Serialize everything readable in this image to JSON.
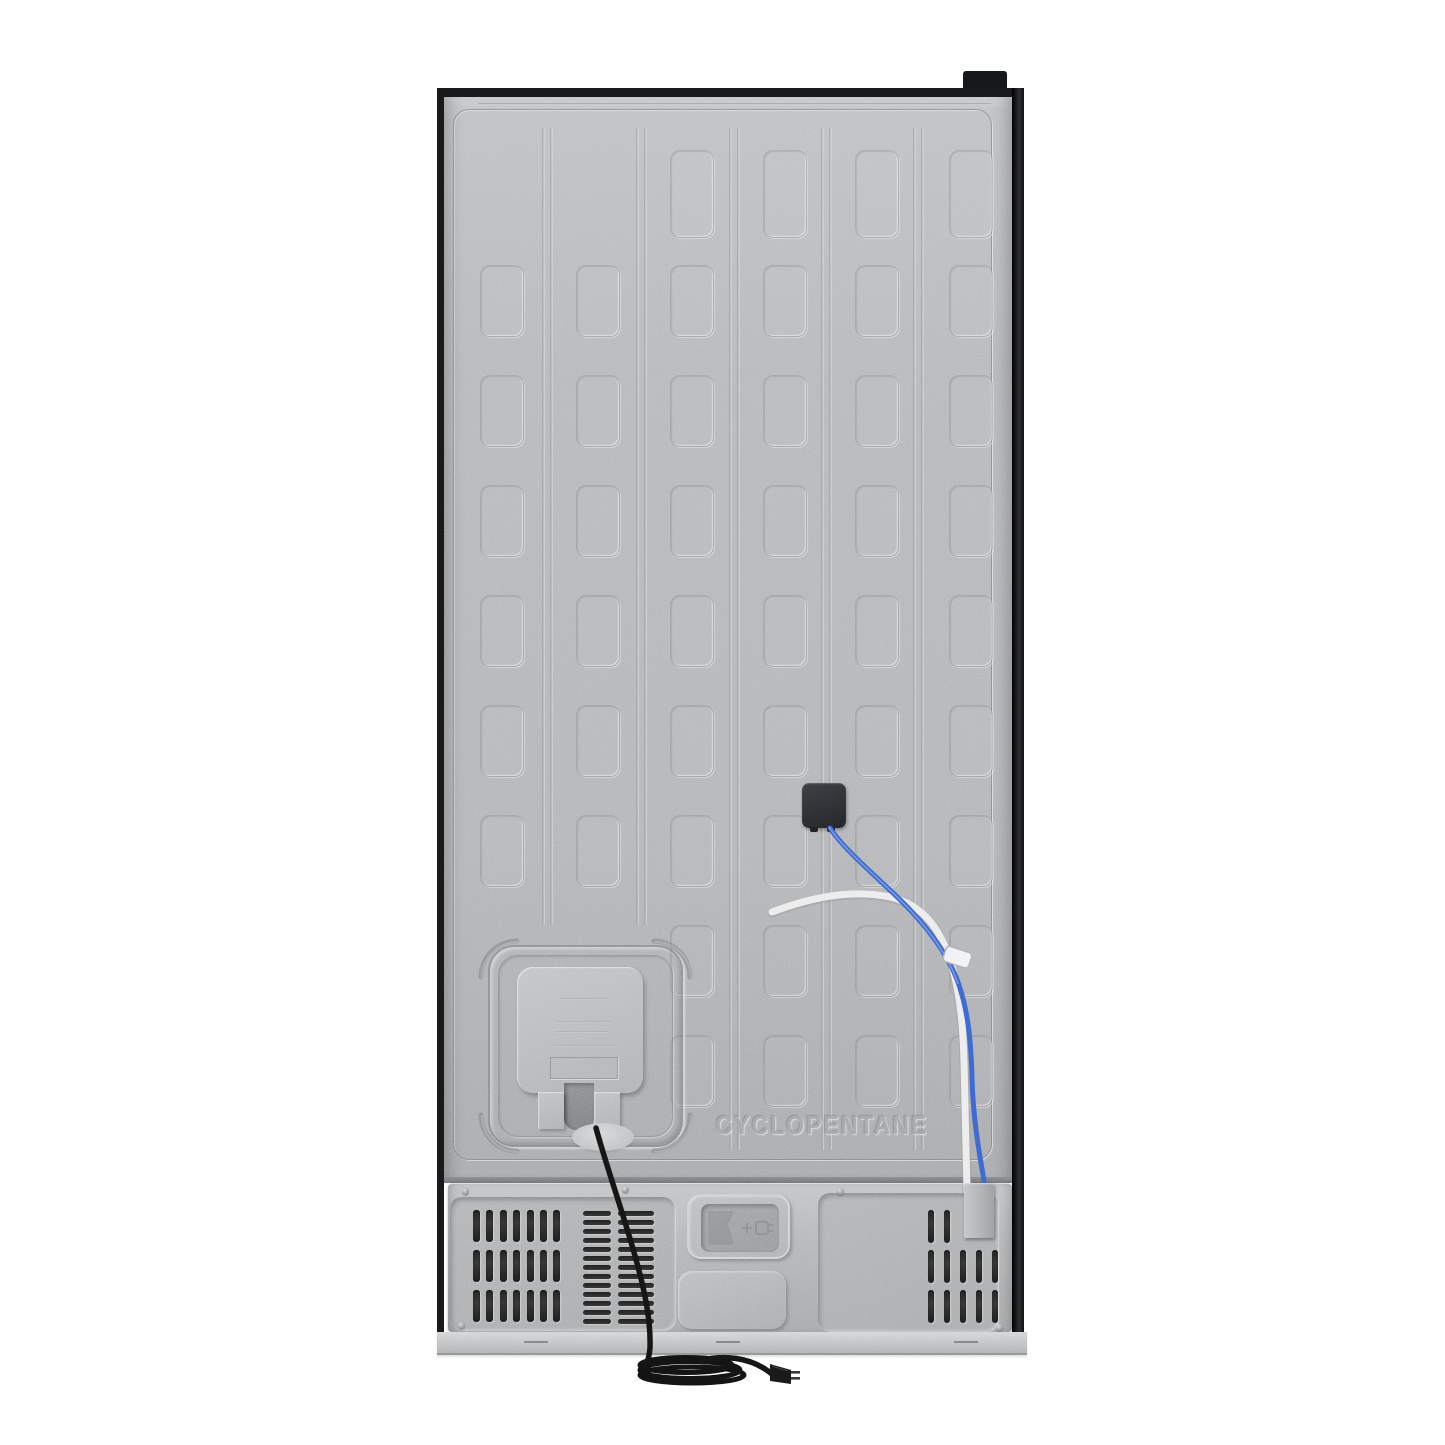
{
  "scene": {
    "type": "product-photo",
    "subject": "Rear view of a refrigerator cabinet",
    "background": "#ffffff"
  },
  "labels": {
    "refrigerant": "CYCLOPENTANE"
  },
  "icons": {
    "plug_emboss": "power-plug-icon"
  },
  "colors": {
    "metal": "#b5b7b9",
    "metal-light": "#c9cbcd",
    "metal-dark": "#95979a",
    "frame": "#17181a",
    "slot": "#2c2c2c",
    "control-box": "#2d3033",
    "blue-wire": "#3f6cd2",
    "white-tube": "#ededee",
    "power-cord": "#161616",
    "base": "#c5c7c9"
  }
}
